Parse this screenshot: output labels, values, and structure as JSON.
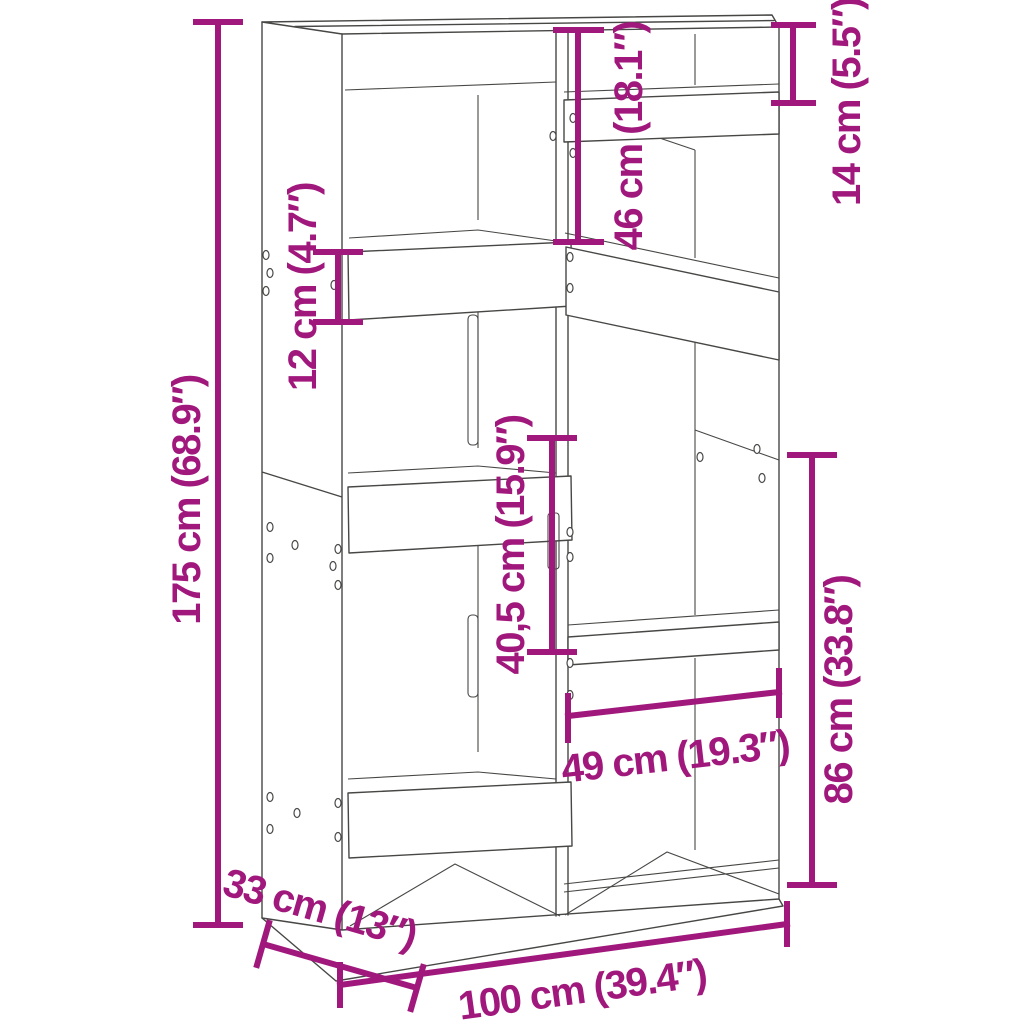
{
  "colors": {
    "background": "#FFFFFF",
    "line_art": "#474745",
    "dimension_accent": "#A1187D"
  },
  "dimensions": {
    "height": {
      "label": "175 cm (68.9″)"
    },
    "width": {
      "label": "100 cm (39.4″)"
    },
    "depth": {
      "label": "33 cm (13″)"
    },
    "top_middle_section_height": {
      "label": "46 cm (18.1″)"
    },
    "top_right_section_height": {
      "label": "14 cm (5.5″)"
    },
    "left_shelf_gap_height": {
      "label": "12 cm (4.7″)"
    },
    "middle_section_height": {
      "label": "40,5 cm (15.9″)"
    },
    "right_compartment_width": {
      "label": "49 cm (19.3″)"
    },
    "right_section_height": {
      "label": "86 cm (33.8″)"
    }
  }
}
